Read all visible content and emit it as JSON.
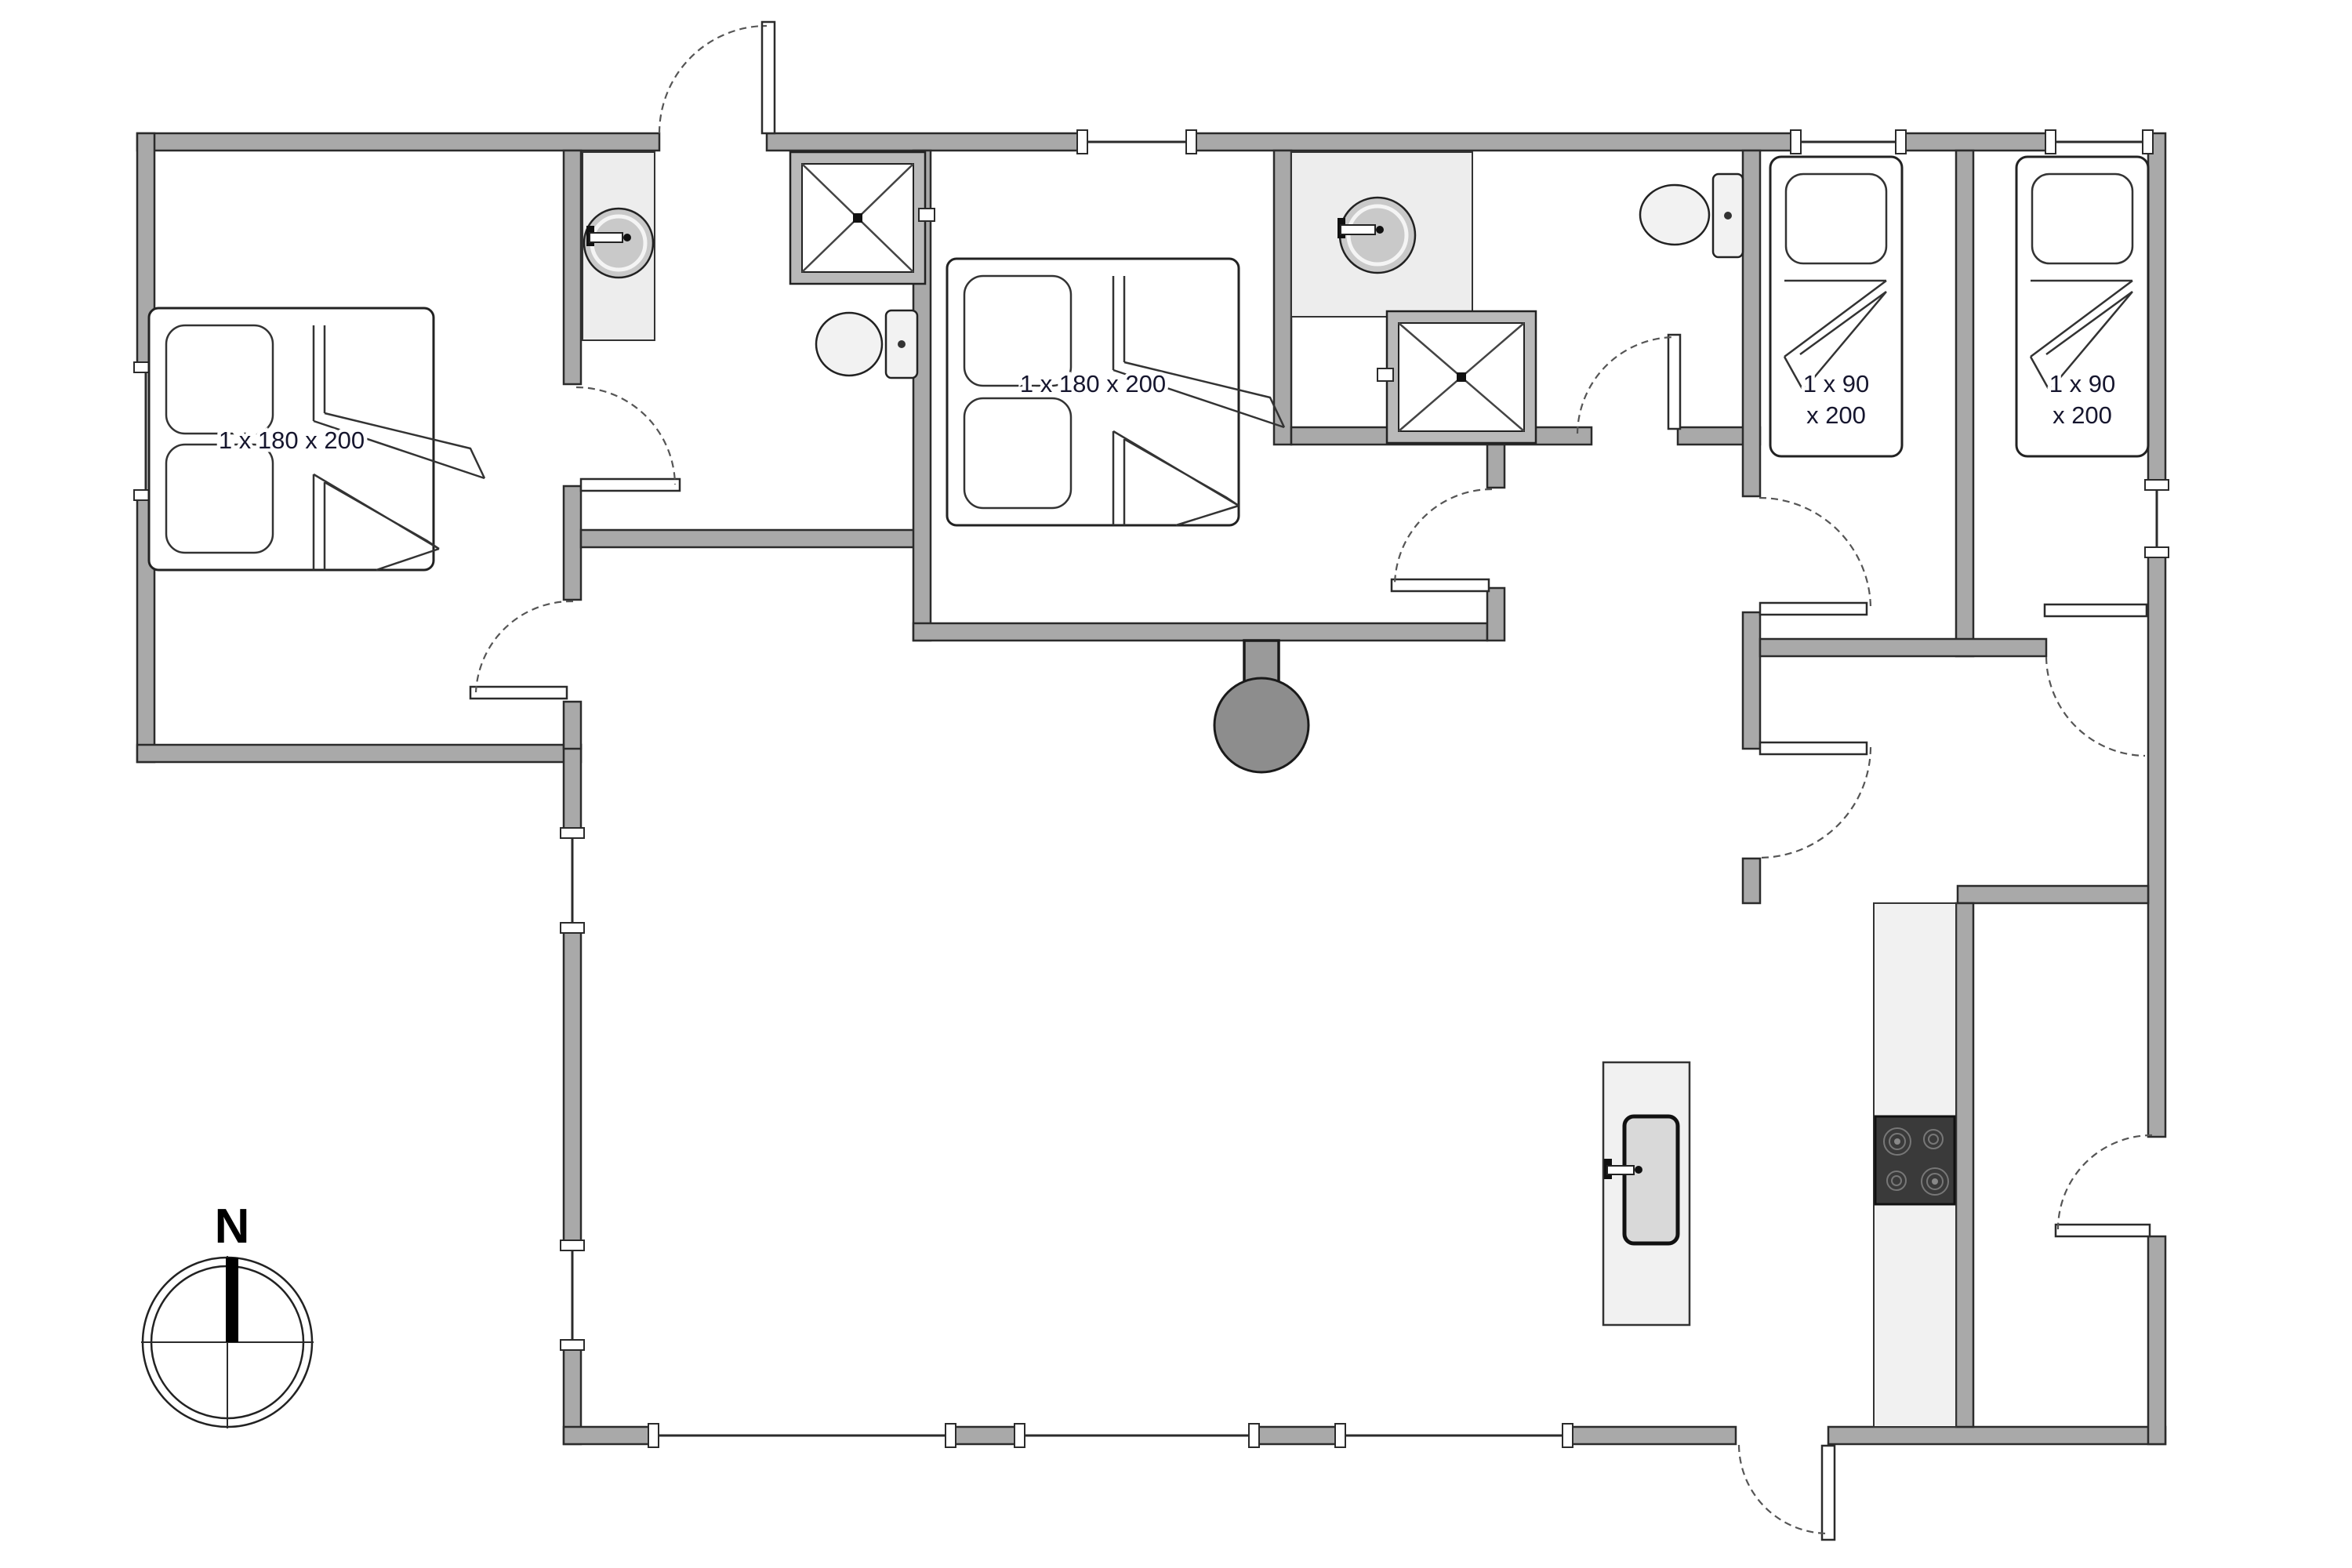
{
  "document": {
    "type": "floor-plan",
    "compass": {
      "north_label": "N"
    },
    "labels": {
      "bedroom1_bed": "1 x 180 x 200",
      "bedroom2_bed": "1 x 180 x 200",
      "single_bed_line1": "1 x 90",
      "single_bed_line2": "x 200"
    },
    "rooms": [
      "bedroom-west",
      "bathroom-west",
      "bedroom-middle",
      "bathroom-east",
      "single-bedroom-1",
      "single-bedroom-2",
      "living-room",
      "kitchen",
      "back-hallway"
    ],
    "fixtures": [
      "double-bed",
      "double-bed",
      "single-bed",
      "single-bed",
      "vanity-sink",
      "vanity-sink",
      "shower",
      "shower",
      "toilet",
      "toilet",
      "wood-stove",
      "kitchen-island-sink",
      "cooktop"
    ],
    "colors": {
      "wall": "#a9a9a9",
      "wall_outline": "#2b2b2b",
      "fixture_light": "#ededed",
      "cooktop_dark": "#3a3a3a",
      "stove_gray": "#8d8d8d",
      "label_text": "#16162e"
    }
  }
}
